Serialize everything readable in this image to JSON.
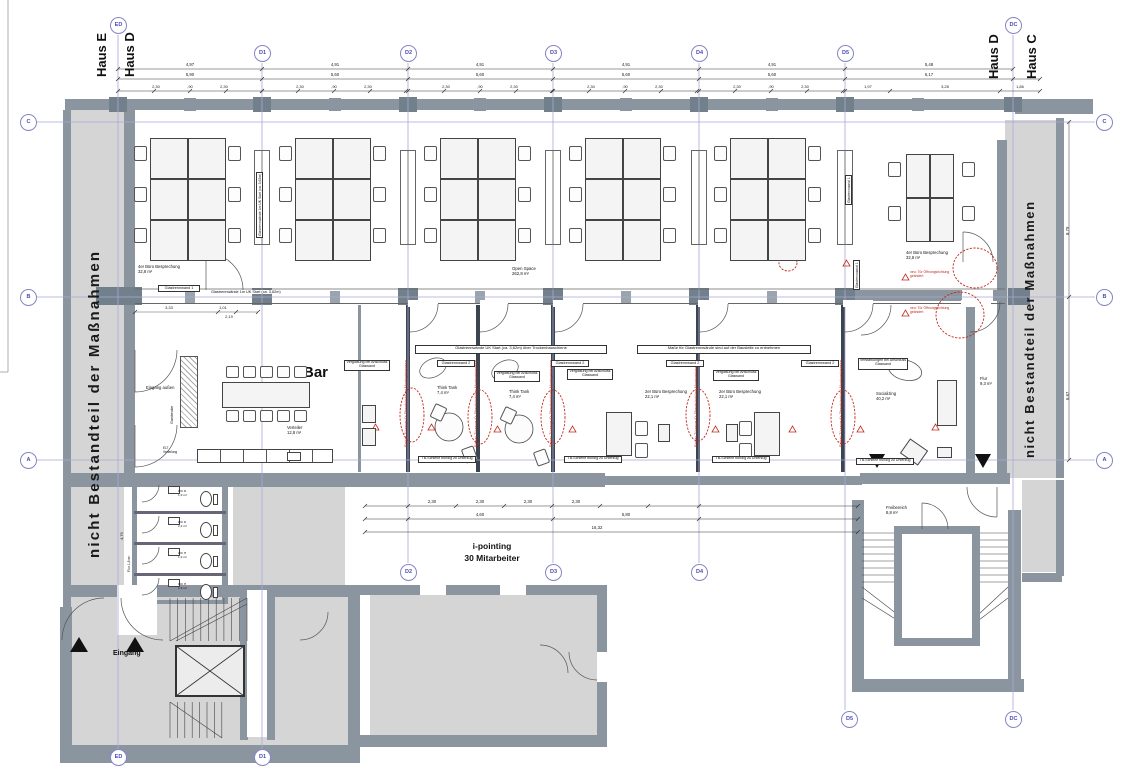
{
  "haus_labels": [
    "Haus E",
    "Haus D",
    "Haus D",
    "Haus C"
  ],
  "excluded_text": "nicht Bestandteil der Maßnahmen",
  "grid": {
    "columns": [
      "ED",
      "D1",
      "D2",
      "D3",
      "D4",
      "D5",
      "DC"
    ],
    "rows": [
      "C",
      "B",
      "A"
    ]
  },
  "texts": {
    "bar": "Bar",
    "eingang": "Eingang",
    "i_pointing": "i-pointing",
    "mitarbeiter": "30 Mitarbeiter",
    "open_space": "Open Space",
    "open_space_area": "262,8 m²"
  },
  "rooms": {
    "think_tank": {
      "name": "Think Tank",
      "area": "7,4 m²"
    },
    "buero2": {
      "name": "2er Büro Besprechung",
      "area": "22,1 m²"
    },
    "buero4": {
      "name": "4er Büro Besprechung",
      "area": "32,8 m²"
    },
    "socializing": {
      "name": "Socializing",
      "area": "40,2 m²"
    },
    "flur_right": {
      "name": "Flur",
      "area": "9,3 m²"
    },
    "flur_wc": {
      "name": "Flur",
      "area": "1,8 m²"
    },
    "verteiler": {
      "name": "Verteiler",
      "area": "12,8 m²"
    },
    "garderobe": "Garderobe",
    "eingang_aussen": "Eingang außen",
    "elt": "ELT Verteilung",
    "freibereich": {
      "name": "Freibereich",
      "area": "8,8 m²"
    },
    "wc_cells": [
      {
        "name": "WC D",
        "area": "1,9 m²"
      },
      {
        "name": "WC D",
        "area": "2,2 m²"
      },
      {
        "name": "WC H",
        "area": "1,9 m²"
      },
      {
        "name": "WC H",
        "area": "1,9 m²"
      }
    ]
  },
  "annotations": {
    "glastrennwand1": "Glastrennwand 1",
    "glastrennwand2": "Glastrennwand 2",
    "verglasung": "Verglasung bei Anschluss Glaswand",
    "verstaerkung": "Verstärkungen bei Anschluss Glaswand",
    "banner_left": "Glastrennwände UK Start (ca. 3,62m) über Trockenbauschiene",
    "banner_right": "Maße für Glastrennwände sind auf der Baustelle zu entnehmen",
    "corridor_note": "Glastrennwände 1m UK Start (ca. 3,62m)",
    "tb_schiene": "TB-Schiene bündig zu Unterzug",
    "tuerzarge": "Einbau Türzarge für Überströmklima Montagehinweise",
    "oeffnung": "neu: Tür Öffnungsrichtung geändert"
  },
  "dimensions": {
    "top_row1": [
      "4,97",
      "4,91",
      "4,91",
      "4,91",
      "4,91",
      "5,48"
    ],
    "top_row2": [
      "5,90",
      "5,60",
      "5,60",
      "5,60",
      "5,60",
      "6,17"
    ],
    "window": "2,30",
    "pier": ",90",
    "top_row3_right": [
      "1,97",
      "3,28",
      "1,86"
    ],
    "top_total": "34,17",
    "bottom_row1": [
      "2,30",
      "2,30",
      "2,30",
      "2,30"
    ],
    "bottom_row2": [
      "4,60",
      "5,80"
    ],
    "bottom_total": "16,32",
    "right_vertical": [
      "8,79",
      "6,67"
    ],
    "left_wc": "4,79",
    "mid": [
      "3,33",
      "1,01",
      "2,19"
    ]
  },
  "colors": {
    "wall": "#8a95a0",
    "floor": "#d5d5d5",
    "column": "#72808c",
    "grid_line": "#a9a9d6",
    "bubble": "#5b5bb5",
    "red": "#c2281d",
    "partition": "#3c4450"
  }
}
